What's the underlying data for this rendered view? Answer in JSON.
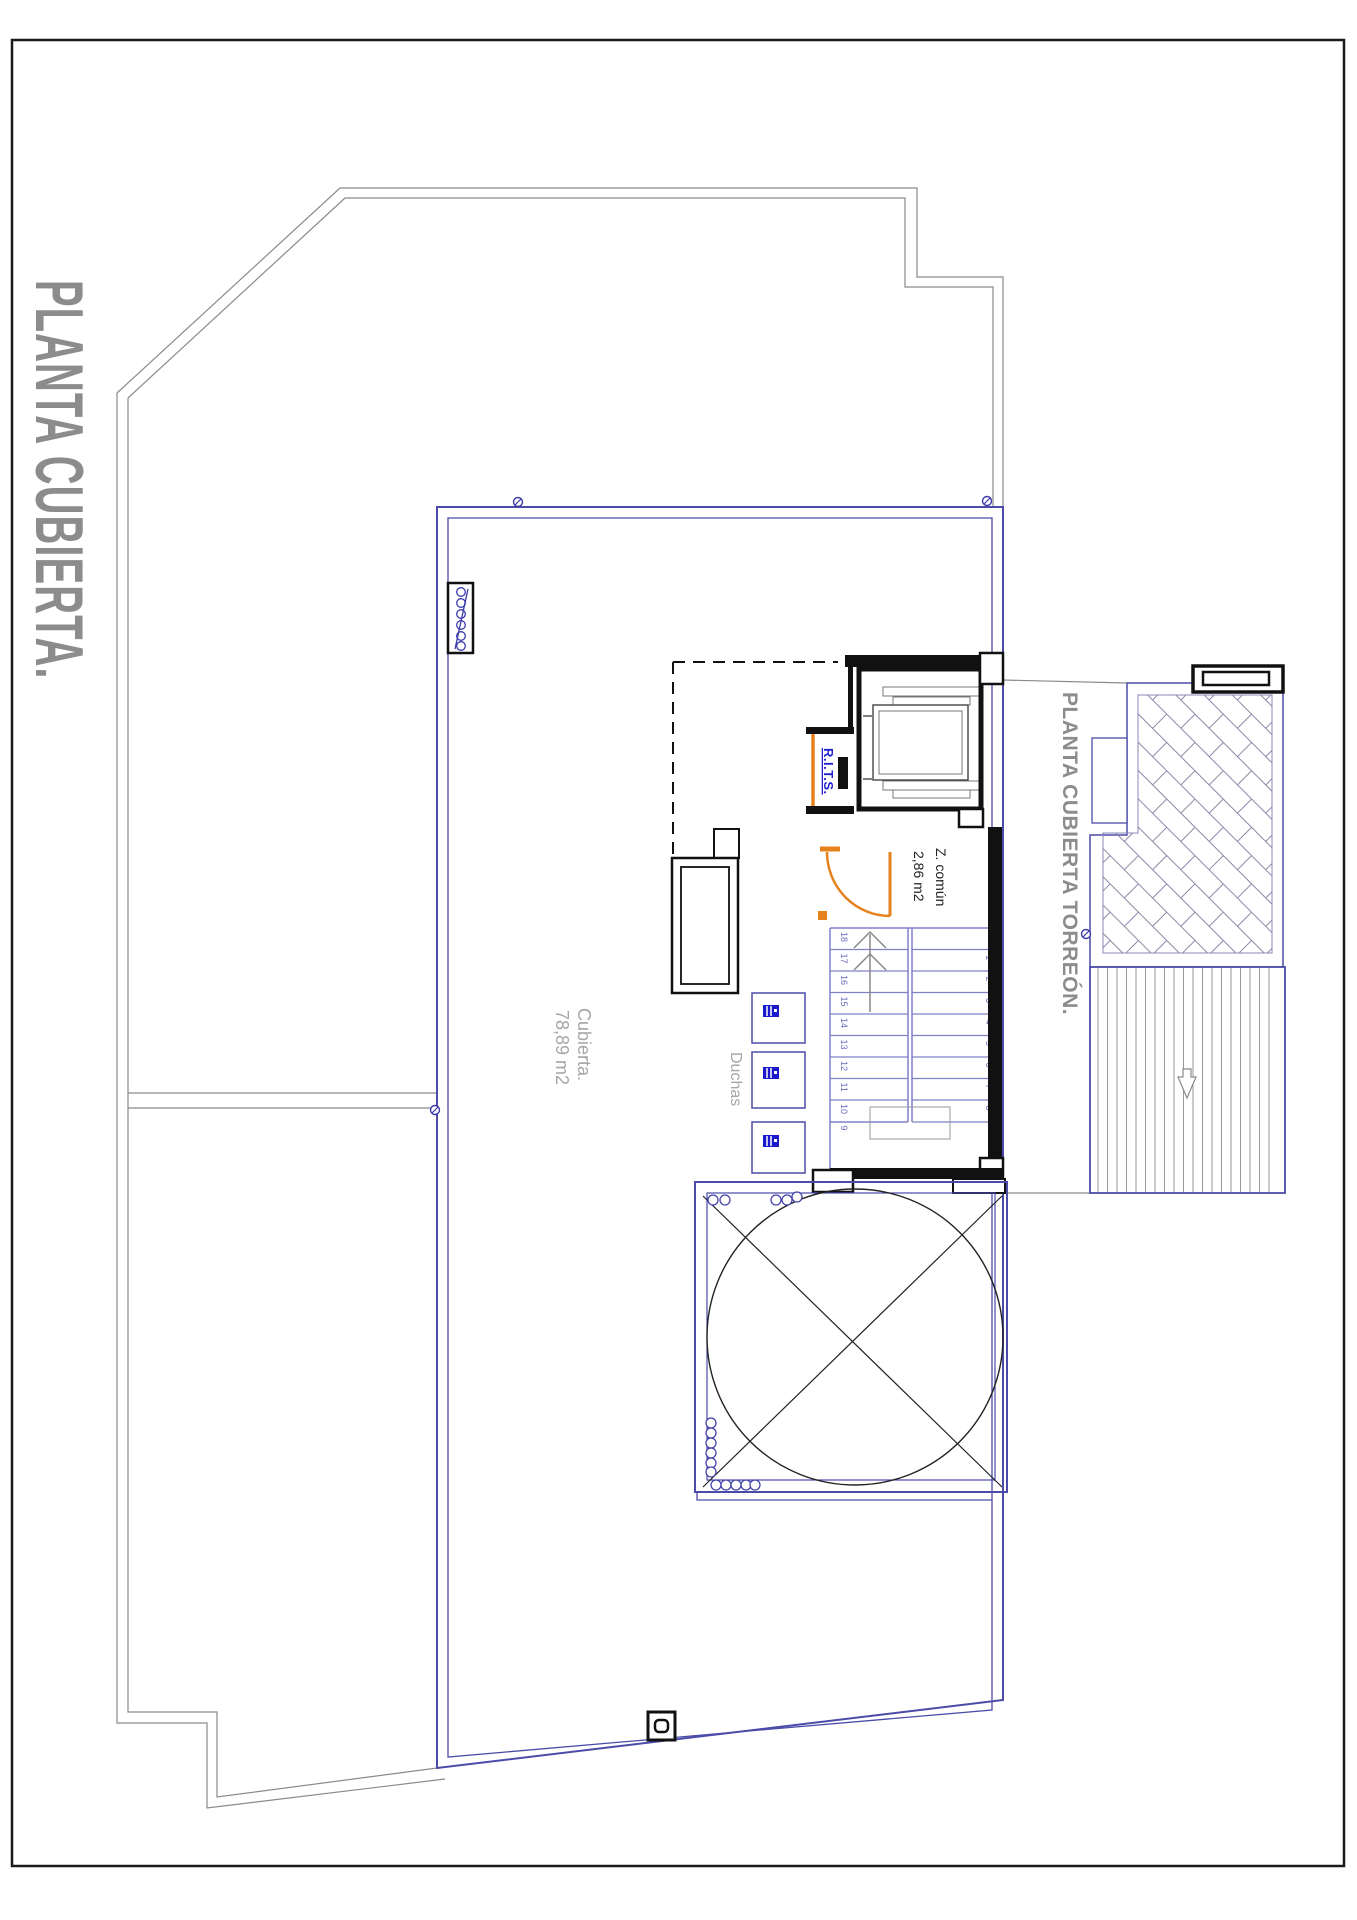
{
  "labels": {
    "main_title": "PLANTA CUBIERTA.",
    "torreon_title": "PLANTA CUBIERTA TORREÓN.",
    "roof_area_line1": "Cubierta.",
    "roof_area_line2": "78,89 m2",
    "showers": "Duchas",
    "common_zone_line1": "Z. común",
    "common_zone_line2": "2,86 m2",
    "rits": "R.I.T.S."
  },
  "stairs": {
    "left_numbers": [
      "18",
      "17",
      "16",
      "15",
      "14",
      "13",
      "12",
      "11",
      "10",
      "9"
    ],
    "right_numbers": [
      "1",
      "2",
      "3",
      "4",
      "5",
      "6",
      "7",
      "8"
    ]
  },
  "colors": {
    "frame": "#1a1a1a",
    "site_outline": "#8a8a8a",
    "roof_blue": "#4b4ba8",
    "tread_blue": "#8080c8",
    "number_blue": "#6b6bbd",
    "title_gray": "#8c8c8c",
    "label_gray": "#a6a6a6",
    "rits_blue": "#1f1fd0",
    "door_orange": "#e6821e",
    "hatch_line": "#8a8aa8",
    "stripe_gray": "#9a9a9a",
    "wall_black": "#111111",
    "text_black": "#222222",
    "marker_blue": "#3a3aad"
  }
}
